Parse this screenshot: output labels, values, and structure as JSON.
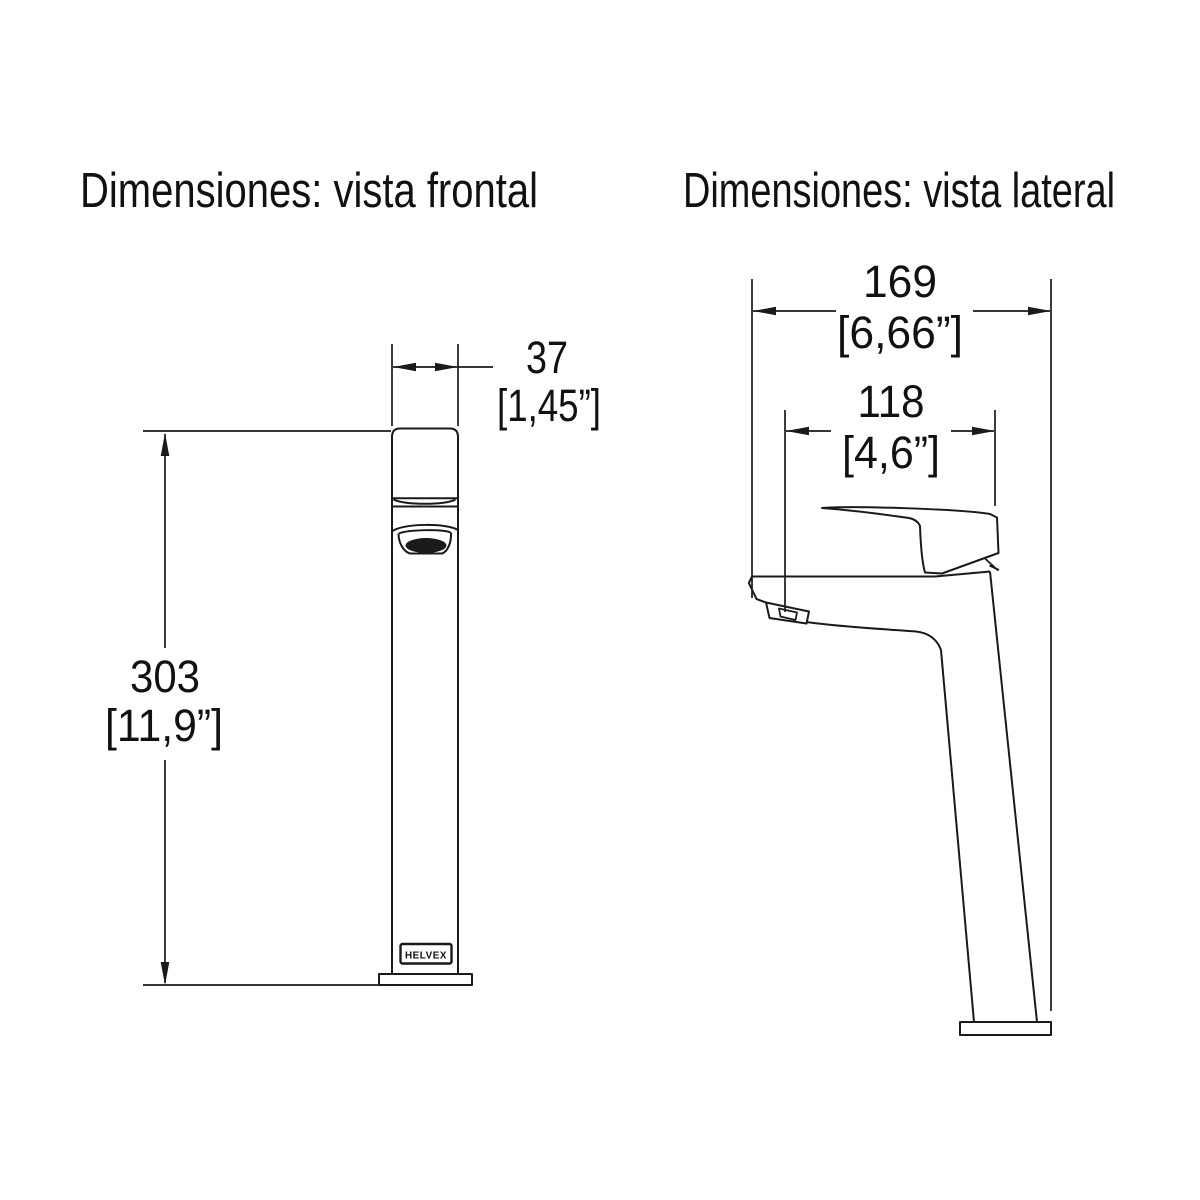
{
  "colors": {
    "background": "#ffffff",
    "line": "#1a1a1a",
    "text": "#111111"
  },
  "front_view": {
    "title": "Dimensiones: vista frontal",
    "logo_text": "HELVEX",
    "dim_width_mm": "37",
    "dim_width_in": "[1,45”]",
    "dim_height_mm": "303",
    "dim_height_in": "[11,9”]"
  },
  "lateral_view": {
    "title": "Dimensiones: vista lateral",
    "dim_depth_mm": "169",
    "dim_depth_in": "[6,66”]",
    "dim_reach_mm": "118",
    "dim_reach_in": "[4,6”]"
  }
}
